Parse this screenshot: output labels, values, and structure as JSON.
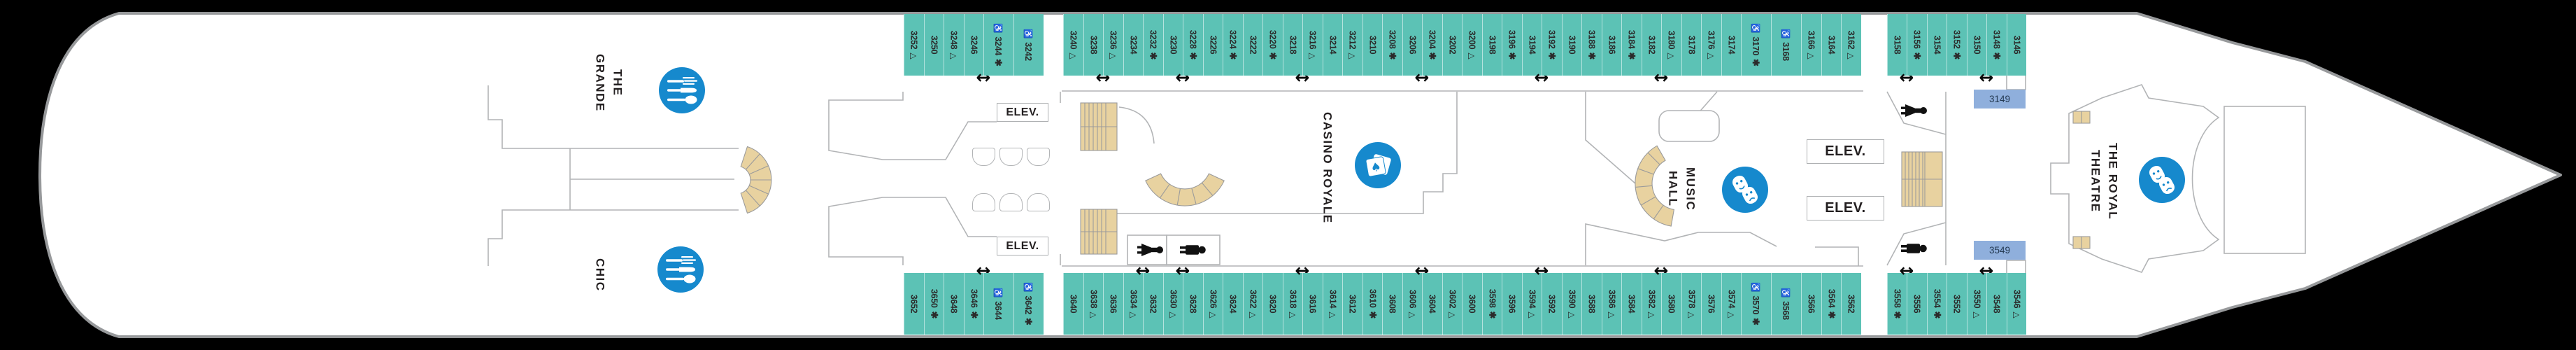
{
  "deck": {
    "venues": [
      {
        "id": "the-grande",
        "label": "THE GRANDE",
        "icon": "dining-icon"
      },
      {
        "id": "chic",
        "label": "CHIC",
        "icon": "dining-icon"
      },
      {
        "id": "casino-royale",
        "label": "CASINO ROYALE",
        "icon": "playing-cards-icon"
      },
      {
        "id": "music-hall",
        "label": "MUSIC\nHALL",
        "icon": "theater-masks-icon"
      },
      {
        "id": "the-royal-theatre",
        "label": "THE ROYAL\nTHEATRE",
        "icon": "theater-masks-icon"
      }
    ],
    "elevator_label": "ELEV.",
    "symbols": {
      "triangle": "△",
      "star": "✱",
      "wheelchair": "♿",
      "connecting_arrow": "↔"
    },
    "highlighted_cabins": [
      {
        "number": "3149"
      },
      {
        "number": "3549"
      }
    ],
    "colors": {
      "cabin_teal": "#5cc2b5",
      "icon_blue": "#1689cd",
      "highlight_blue": "#8fafdc",
      "stair_tan": "#e8d2a0",
      "hull_outline": "#97999b",
      "wall_gray": "#b2b4b6",
      "background": "#000000"
    },
    "cabin_rows": {
      "port": [
        {
          "n": "3252",
          "m": "tri"
        },
        {
          "n": "3250"
        },
        {
          "n": "3248",
          "m": "tri"
        },
        {
          "n": "3246",
          "arrow": true
        },
        {
          "n": "3244",
          "wc": true,
          "m": "star"
        },
        {
          "n": "3242",
          "wc": true,
          "gap": 28
        },
        {
          "n": "3240",
          "m": "tri"
        },
        {
          "n": "3238",
          "arrow": true
        },
        {
          "n": "3236",
          "m": "tri"
        },
        {
          "n": "3234"
        },
        {
          "n": "3232",
          "m": "star"
        },
        {
          "n": "3230",
          "arrow": true
        },
        {
          "n": "3228",
          "m": "star"
        },
        {
          "n": "3226"
        },
        {
          "n": "3224",
          "m": "star"
        },
        {
          "n": "3222"
        },
        {
          "n": "3220",
          "m": "star"
        },
        {
          "n": "3218",
          "arrow": true
        },
        {
          "n": "3216",
          "m": "tri"
        },
        {
          "n": "3214"
        },
        {
          "n": "3212",
          "m": "tri"
        },
        {
          "n": "3210"
        },
        {
          "n": "3208",
          "m": "star"
        },
        {
          "n": "3206",
          "arrow": true
        },
        {
          "n": "3204",
          "m": "star"
        },
        {
          "n": "3202"
        },
        {
          "n": "3200",
          "m": "tri"
        },
        {
          "n": "3198"
        },
        {
          "n": "3196",
          "m": "star"
        },
        {
          "n": "3194",
          "arrow": true
        },
        {
          "n": "3192",
          "m": "star"
        },
        {
          "n": "3190"
        },
        {
          "n": "3188",
          "m": "star"
        },
        {
          "n": "3186"
        },
        {
          "n": "3184",
          "m": "star"
        },
        {
          "n": "3182",
          "arrow": true
        },
        {
          "n": "3180",
          "m": "tri"
        },
        {
          "n": "3178"
        },
        {
          "n": "3176",
          "m": "tri"
        },
        {
          "n": "3174"
        },
        {
          "n": "3170",
          "wc": true,
          "m": "star"
        },
        {
          "n": "3168",
          "wc": true
        },
        {
          "n": "3166",
          "m": "tri"
        },
        {
          "n": "3164"
        },
        {
          "n": "3162",
          "m": "tri",
          "gap": 37
        },
        {
          "n": "3158",
          "arrow": true
        },
        {
          "n": "3156",
          "m": "star"
        },
        {
          "n": "3154"
        },
        {
          "n": "3152",
          "m": "star"
        },
        {
          "n": "3150",
          "arrow": true
        },
        {
          "n": "3148",
          "m": "star"
        },
        {
          "n": "3146"
        }
      ],
      "starboard": [
        {
          "n": "3652"
        },
        {
          "n": "3650",
          "m": "star"
        },
        {
          "n": "3648"
        },
        {
          "n": "3646",
          "m": "star",
          "arrow": true
        },
        {
          "n": "3644",
          "wc": true
        },
        {
          "n": "3642",
          "wc": true,
          "m": "star",
          "gap": 28
        },
        {
          "n": "3640"
        },
        {
          "n": "3638",
          "m": "tri"
        },
        {
          "n": "3636"
        },
        {
          "n": "3634",
          "m": "tri",
          "arrow": true
        },
        {
          "n": "3632"
        },
        {
          "n": "3630",
          "m": "tri",
          "arrow": true
        },
        {
          "n": "3628"
        },
        {
          "n": "3626",
          "m": "tri"
        },
        {
          "n": "3624"
        },
        {
          "n": "3622",
          "m": "tri"
        },
        {
          "n": "3620"
        },
        {
          "n": "3618",
          "m": "tri",
          "arrow": true
        },
        {
          "n": "3616"
        },
        {
          "n": "3614",
          "m": "tri"
        },
        {
          "n": "3612"
        },
        {
          "n": "3610",
          "m": "star"
        },
        {
          "n": "3608"
        },
        {
          "n": "3606",
          "m": "tri",
          "arrow": true
        },
        {
          "n": "3604"
        },
        {
          "n": "3602",
          "m": "tri"
        },
        {
          "n": "3600"
        },
        {
          "n": "3598",
          "m": "star"
        },
        {
          "n": "3596"
        },
        {
          "n": "3594",
          "m": "tri",
          "arrow": true
        },
        {
          "n": "3592"
        },
        {
          "n": "3590",
          "m": "tri"
        },
        {
          "n": "3588"
        },
        {
          "n": "3586",
          "m": "tri"
        },
        {
          "n": "3584"
        },
        {
          "n": "3582",
          "m": "tri",
          "arrow": true
        },
        {
          "n": "3580"
        },
        {
          "n": "3578",
          "m": "tri"
        },
        {
          "n": "3576"
        },
        {
          "n": "3574",
          "m": "tri"
        },
        {
          "n": "3570",
          "wc": true,
          "m": "star"
        },
        {
          "n": "3568",
          "wc": true
        },
        {
          "n": "3566"
        },
        {
          "n": "3564",
          "m": "star"
        },
        {
          "n": "3562",
          "gap": 37
        },
        {
          "n": "3558",
          "m": "star",
          "arrow": true
        },
        {
          "n": "3556"
        },
        {
          "n": "3554",
          "m": "star"
        },
        {
          "n": "3552"
        },
        {
          "n": "3550",
          "m": "tri",
          "arrow": true
        },
        {
          "n": "3548"
        },
        {
          "n": "3546",
          "m": "tri"
        }
      ]
    }
  }
}
